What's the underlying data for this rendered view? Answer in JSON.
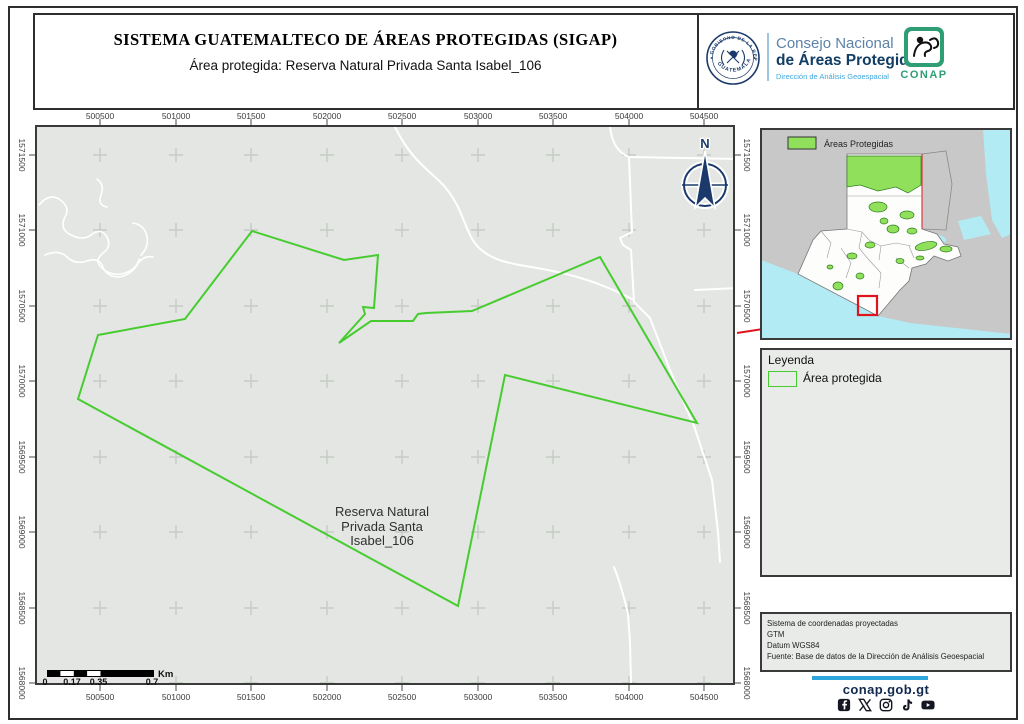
{
  "header": {
    "title": "SISTEMA GUATEMALTECO DE ÁREAS PROTEGIDAS  (SIGAP)",
    "subtitle": "Área protegida: Reserva Natural Privada Santa Isabel_106",
    "seal_arc_top": "GOBIERNO DE LA REPÚBLICA",
    "seal_arc_bottom": "GUATEMALA",
    "org_line1": "Consejo Nacional",
    "org_line2": "de Áreas Protegidas",
    "org_line3": "Dirección de Análisis Geoespacial",
    "conap_label": "CONAP"
  },
  "map": {
    "x_ticks": [
      "500500",
      "501000",
      "501500",
      "502000",
      "502500",
      "503000",
      "503500",
      "504000",
      "504500"
    ],
    "y_ticks": [
      "1571500",
      "1571000",
      "1570500",
      "1570000",
      "1569500",
      "1569000",
      "1568500",
      "1568000"
    ],
    "area_label_lines": [
      "Reserva Natural",
      "Privada Santa",
      "Isabel_106"
    ],
    "north_label": "N",
    "scalebar": {
      "labels": [
        "0",
        "0.17",
        "0.35",
        "0.7"
      ],
      "unit": "Km"
    }
  },
  "overview": {
    "legend_label": "Áreas Protegidas"
  },
  "legend": {
    "title": "Leyenda",
    "item_label": "Área protegida"
  },
  "credits": {
    "lines": [
      "Sistema de coordenadas proyectadas",
      "GTM",
      "Datum WGS84",
      "Fuente: Base de datos de la Dirección de Análisis Geoespacial"
    ]
  },
  "footer": {
    "website": "conap.gob.gt",
    "icons": [
      "facebook-icon",
      "x-icon",
      "instagram-icon",
      "tiktok-icon",
      "youtube-icon"
    ]
  },
  "colors": {
    "reserve_outline": "#47cc30",
    "protected_fill": "#90e05c",
    "navy": "#1b3a6b",
    "conap_green": "#2f9e75",
    "alert_red": "#e1131d",
    "water": "#b3ebf4",
    "land_gray": "#c8c8c8",
    "map_bg": "#e3e6e2",
    "footer_blue": "#2ea8dc"
  }
}
